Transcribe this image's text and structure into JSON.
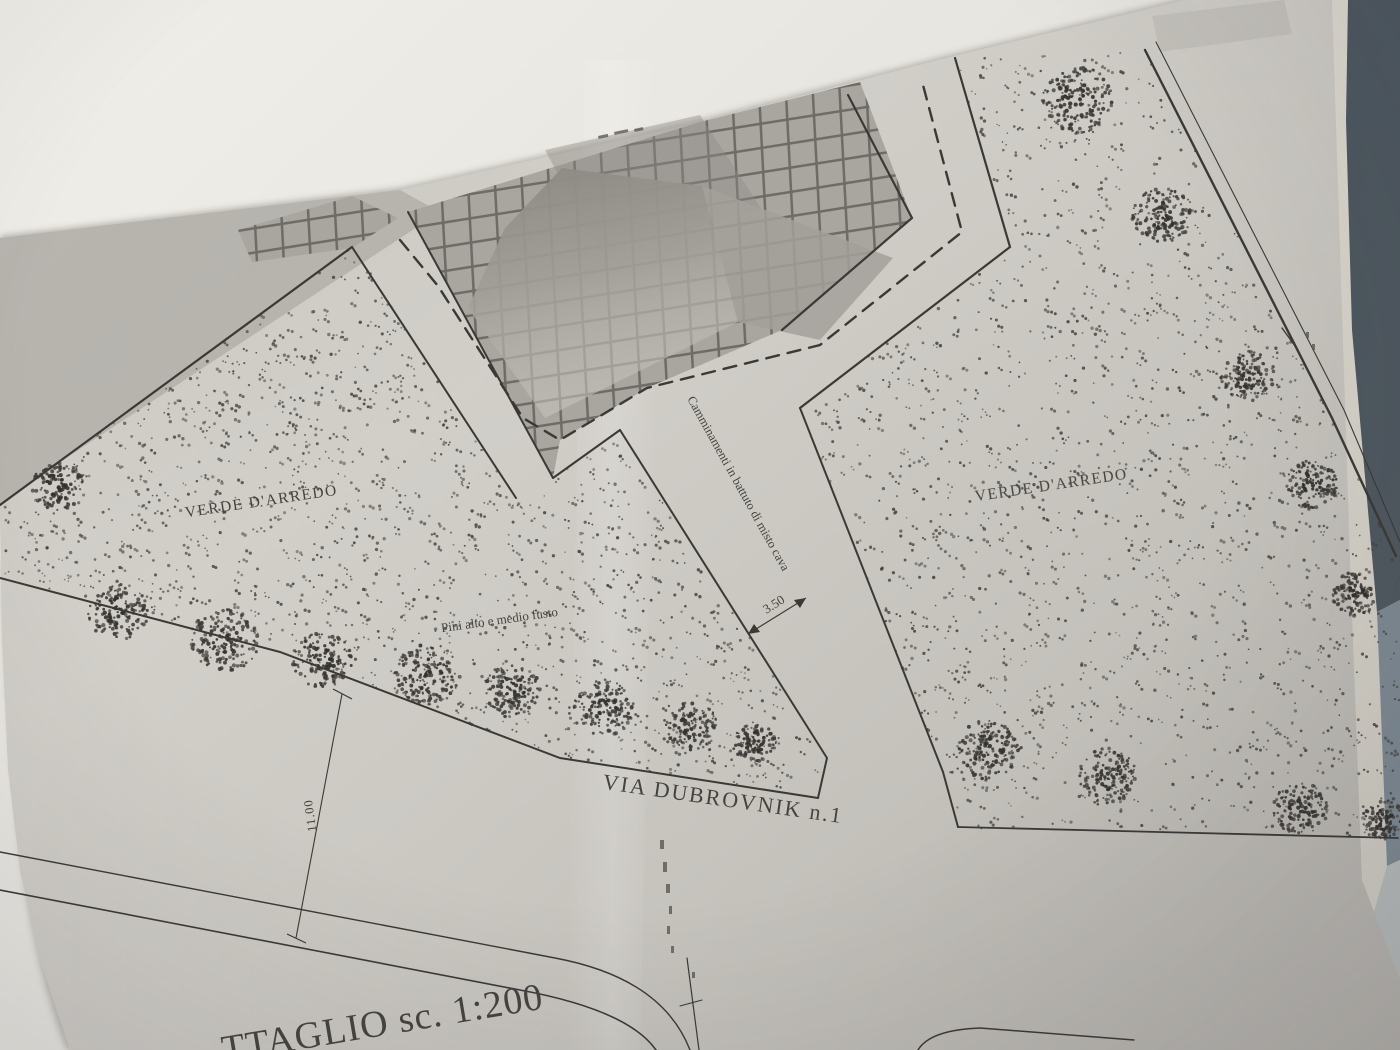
{
  "plan": {
    "labels": {
      "green_left": "VERDE D'ARREDO",
      "green_right": "VERDE D'ARREDO",
      "walkway": "Camminamenti in battuto di misto cava",
      "trees": "Pini alto e medio fusto",
      "street": "VIA DUBROVNIK n.1",
      "scale_note": "TTAGLIO sc. 1:200"
    },
    "dimensions": {
      "walkway_width": "3.50",
      "green_depth": "11.00"
    },
    "colors": {
      "paper": "#d6d3cd",
      "ink": "#3b3936",
      "background": "#f1efe9",
      "object_navy": "#46525c",
      "object_slate": "#7f8f9b"
    }
  }
}
